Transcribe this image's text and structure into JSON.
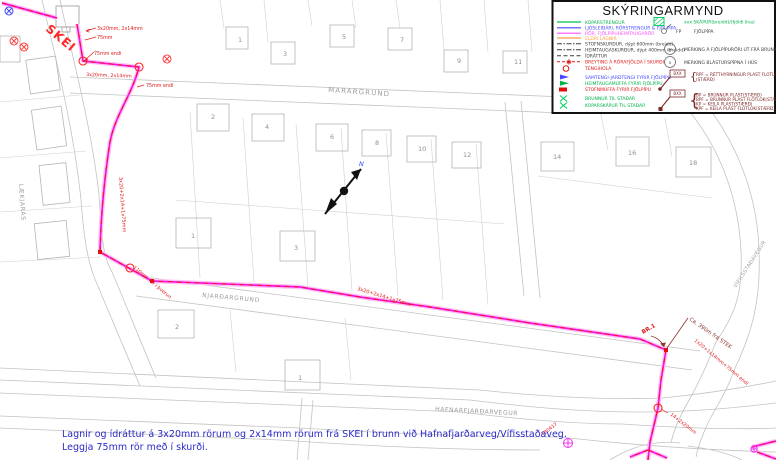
{
  "colors": {
    "route_magenta": "#f018f0",
    "route_casing": "#ffc2f2",
    "idrattur_red": "#ff1010",
    "annotation_red": "#e01818",
    "annotation_maroon": "#8a3530",
    "note_blue": "#2a2ac8",
    "linework_gray": "#c3c3c3",
    "legend_green": "#00b34c",
    "legend_blue": "#4848ff",
    "legend_magenta": "#ff50ff",
    "legend_orange": "#ff9f45"
  },
  "legend": {
    "title": "SKÝRINGARMYND",
    "items": [
      {
        "label": "KOPARSTRENGUR"
      },
      {
        "label": "LJÓSLEIÐARI, RÖRSTRENGUR & FJÖLPÍPA"
      },
      {
        "label": "RÖR, FJÖLPÍPUHEIMTAUGARÖR"
      },
      {
        "label": "ELDRI LAGNIR"
      },
      {
        "label": "STOFNSKURÐUR, dýpt 600mm (breidd)"
      },
      {
        "label": "HEIMTAUGASKURÐUR, dýpt 400mm (breidd)"
      },
      {
        "label": "ÍDRÁTTUR"
      },
      {
        "label": "BREYTING Á RÖRAFJÖLDA Í SKURÐI"
      },
      {
        "label": "TENGIHOLA"
      },
      {
        "label": "SAMTENGI-JARÐTENGI FYRIR FJÖLPÍPU"
      },
      {
        "label": "HEIMTAUGAMÚFFA FYRIR FJÖLPÍPU"
      },
      {
        "label": "STOFNMÚFFA FYRIR FJÖLPÍPU"
      },
      {
        "label": "BRUNNUR TIL STAÐAR"
      },
      {
        "label": "KOPARSKÁPUR TIL STAÐAR"
      }
    ],
    "right": {
      "skapur": "xxx SKÁPUR(breidd)/(fjöldi lína)",
      "fp_code": "FP",
      "fp": "FJÖLPÍPA",
      "p4_code": "4P",
      "p4": "MERKING Á FJÖLPÍPURÖRI ÚT FRÁ BRUNNI",
      "x_code": "x",
      "x": "MERKING BLÁSTURSPÍPNA Í HÚS",
      "bxx": "BXX",
      "rpf1": "RPF = RÉTTHYRNINGUR PLAST FLOTLOK",
      "rpf2": "(STÆRÐ)",
      "bp": "BP  = BRUNNUR PLAST(STÆRÐ)",
      "bpf": "BPF = BRUNNUR PLAST FLOTLOK(STÆRÐ)",
      "kp": "KP  = KEILA PLAST(STÆRÐ)",
      "kpf": "KPF = KEILA PLAST FLOTLOK(STÆRÐ)"
    }
  },
  "streets": {
    "marargrund": "MARARGRUND",
    "njardargrund": "NJARÐARGRUND",
    "hafnarfjardarvegur": "HAFNARFJARÐARVEGUR",
    "laekjaras": "LÆKJARÁS",
    "vifilsstadavegur": "VÍFILSSTAÐAVEGUR"
  },
  "ann": {
    "skei": "SKEI",
    "top1": "3x20mm, 2x14mm",
    "top2": "75mm",
    "top3": "75mm endi",
    "mid1": "3x20mm, 2x14mm",
    "mid2": "75mm endi",
    "vert": "3x20+2x14+1x75mm",
    "cross": "110mm rör í þverun",
    "njard": "3x20+2x14+1x75mm",
    "br1": "BR.1",
    "stek": "Ca. 390m frá STEK",
    "east": "1x20+1x14mm+75mm endi",
    "south": "14+2x20mm",
    "tb": "TB0417"
  },
  "plots": [
    "1",
    "3",
    "5",
    "7",
    "9",
    "11",
    "2",
    "4",
    "6",
    "8",
    "10",
    "12",
    "14",
    "16",
    "18",
    "1",
    "3",
    "2",
    "1"
  ],
  "note": {
    "line1": "Lagnir og ídráttur á 3x20mm rörum og 2x14mm rörum frá SKEI í brunn við Hafnafjarðarveg/Vífisstaðaveg.",
    "line2": "Leggja 75mm rör með í skurði."
  },
  "compass": {
    "label": "N"
  }
}
